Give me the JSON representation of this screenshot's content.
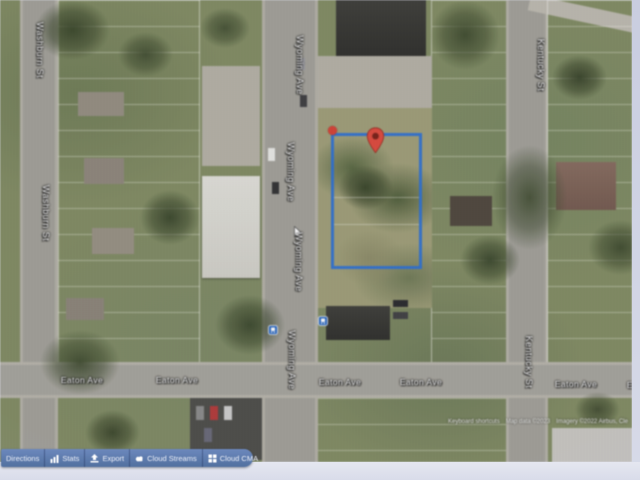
{
  "map": {
    "labels": {
      "washburn_top": "Washburn St",
      "washburn_mid": "Washburn St",
      "wyoming_1": "Wyoming Ave",
      "wyoming_2": "Wyoming Ave",
      "wyoming_3": "Wyoming Ave",
      "wyoming_4": "Wyoming Ave",
      "kentucky_top": "Kentucky St",
      "kentucky_mid": "Kentucky St",
      "eaton_1": "Eaton Ave",
      "eaton_2": "Eaton Ave",
      "eaton_3": "Eaton Ave",
      "eaton_4": "Eaton Ave",
      "eaton_5": "Eaton Ave",
      "eaton_6": "Eaton Ave"
    },
    "attribution": {
      "keyboard": "Keyboard shortcuts",
      "map_data": "Map data ©2023",
      "imagery": "Imagery ©2022 Airbus, Cle"
    },
    "markers": {
      "pin": "location-pin",
      "vertex_dot": "parcel-vertex-dot",
      "transit_stop": "transit-stop"
    },
    "parcel_outline_color": "#206ee1",
    "pin_color": "#ea4335"
  },
  "toolbar": {
    "bg_color": "#5a79b4",
    "buttons": [
      {
        "label": "Directions",
        "icon": "directions-icon"
      },
      {
        "label": "Stats",
        "icon": "stats-icon"
      },
      {
        "label": "Export",
        "icon": "export-icon"
      },
      {
        "label": "Cloud Streams",
        "icon": "cloud-streams-icon"
      },
      {
        "label": "Cloud CMA",
        "icon": "cloud-cma-icon"
      }
    ]
  }
}
